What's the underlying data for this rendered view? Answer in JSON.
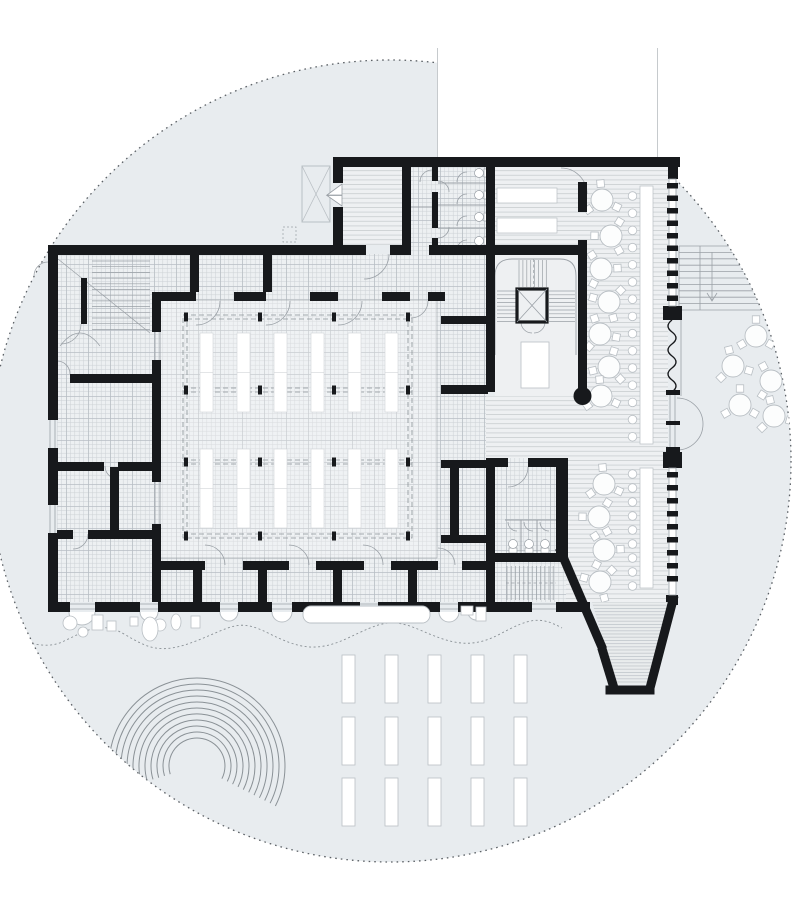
{
  "title": "ground-floor architectural plan on circular site",
  "colors": {
    "site": "#e8ecef",
    "siteEdge": "#5c6166",
    "wall": "#17191c",
    "gridBg": "#edf0f2",
    "gridLine": "#ccd1d5",
    "gridMajor": "#b8bec4",
    "hallBg": "#eff2f4",
    "hallLine": "#d9dcdf",
    "hallMajor": "#c9cdd1",
    "stripeBg": "#eef0f2",
    "stripeLine": "#c3c8cc",
    "denseBg": "#e9eced",
    "denseLine": "#b4bac0",
    "thin": "#9aa0a6",
    "faint": "#c6cacd",
    "furn": "#b9bfc4",
    "dash": "#8a9196",
    "white": "#ffffff"
  },
  "site": {
    "circle": {
      "cx": 390,
      "cy": 461,
      "r": 401
    },
    "ground_rects": {
      "cols": [
        342,
        385,
        428,
        471,
        514
      ],
      "rows": [
        655,
        717,
        778
      ],
      "w": 13,
      "h": 48
    },
    "amphitheater": {
      "cx": 197,
      "cy": 766,
      "r_start": 28,
      "r_step": 6,
      "count": 11,
      "deg_start": 197,
      "deg_end": -27
    }
  },
  "hall": {
    "strip_cols": [
      200,
      237,
      274,
      311,
      348,
      385
    ],
    "strip_rows": [
      333,
      449
    ],
    "strip_w": 13,
    "strip_h": 79,
    "column_xs": [
      186,
      260,
      334,
      408
    ],
    "column_ys": [
      317,
      390,
      462,
      536
    ]
  },
  "furniture": {
    "tables_upper": [
      [
        602,
        200
      ],
      [
        611,
        236
      ],
      [
        601,
        269
      ],
      [
        609,
        302
      ],
      [
        600,
        334
      ],
      [
        609,
        367
      ],
      [
        601,
        396
      ]
    ],
    "tables_lower": [
      [
        604,
        484
      ],
      [
        599,
        517
      ],
      [
        604,
        550
      ],
      [
        600,
        582
      ]
    ],
    "tables_terrace": [
      [
        756,
        336
      ],
      [
        733,
        366
      ],
      [
        771,
        381
      ],
      [
        740,
        405
      ],
      [
        774,
        416
      ]
    ],
    "stools_upper": {
      "x": 632.5,
      "y0": 196,
      "step": 17.2,
      "count": 15
    },
    "stools_lower": {
      "x": 632.5,
      "y0": 474,
      "step": 14,
      "count": 9
    },
    "wc_wing_ys": [
      173,
      195,
      217,
      241
    ],
    "wc_lower_xs": [
      513,
      529,
      545
    ]
  },
  "glazing": {
    "x": 667,
    "w": 11,
    "h": 5.5,
    "top_ys": [
      183,
      195.5,
      208,
      220.5,
      233,
      245.5,
      258,
      270.5,
      283,
      295.5
    ],
    "bottom_ys": [
      472,
      485,
      498,
      511,
      524,
      537,
      550,
      563,
      576
    ]
  },
  "inventory": {
    "cafe_tables_upper": 7,
    "cafe_tables_lower": 4,
    "terrace_tables": 5,
    "bar_stools": 24,
    "hall_stack_strips": 12,
    "hall_columns": 16,
    "wc_stalls_wing": 4,
    "wc_stalls_lower": 3,
    "outdoor_planter_rects": 15,
    "amphitheater_rings": 11
  }
}
